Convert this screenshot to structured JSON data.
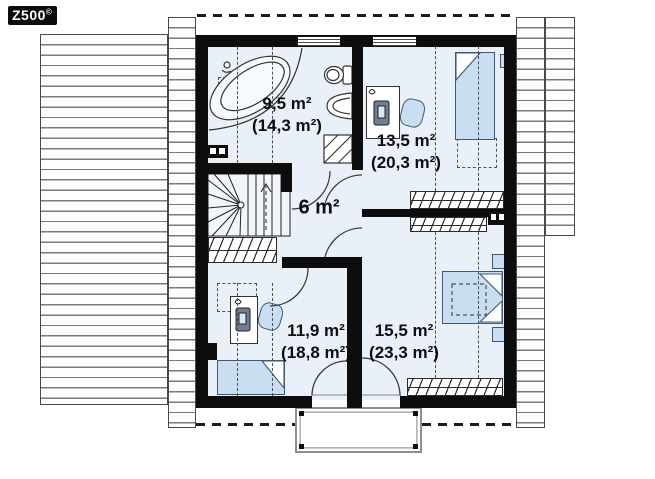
{
  "logo": {
    "text": "Z500",
    "sup": "©"
  },
  "rooms": {
    "bathroom": {
      "area": "9,5 m²",
      "total": "(14,3 m²)"
    },
    "bedroom_top_right": {
      "area": "13,5 m²",
      "total": "(20,3 m²)"
    },
    "hall": {
      "area": "6 m²"
    },
    "bedroom_bottom_left": {
      "area": "11,9 m²",
      "total": "(18,8 m²)"
    },
    "bedroom_bottom_right": {
      "area": "15,5 m²",
      "total": "(23,3 m²)"
    }
  },
  "colors": {
    "wall": "#0d0d0d",
    "room_fill": "#e9f0f8",
    "furniture_fill": "#c9def1",
    "roof_line": "#7a7a7a",
    "dash_line": "#4f4f4f",
    "logo_bg": "#0c0c0c",
    "logo_text": "#ffffff"
  }
}
